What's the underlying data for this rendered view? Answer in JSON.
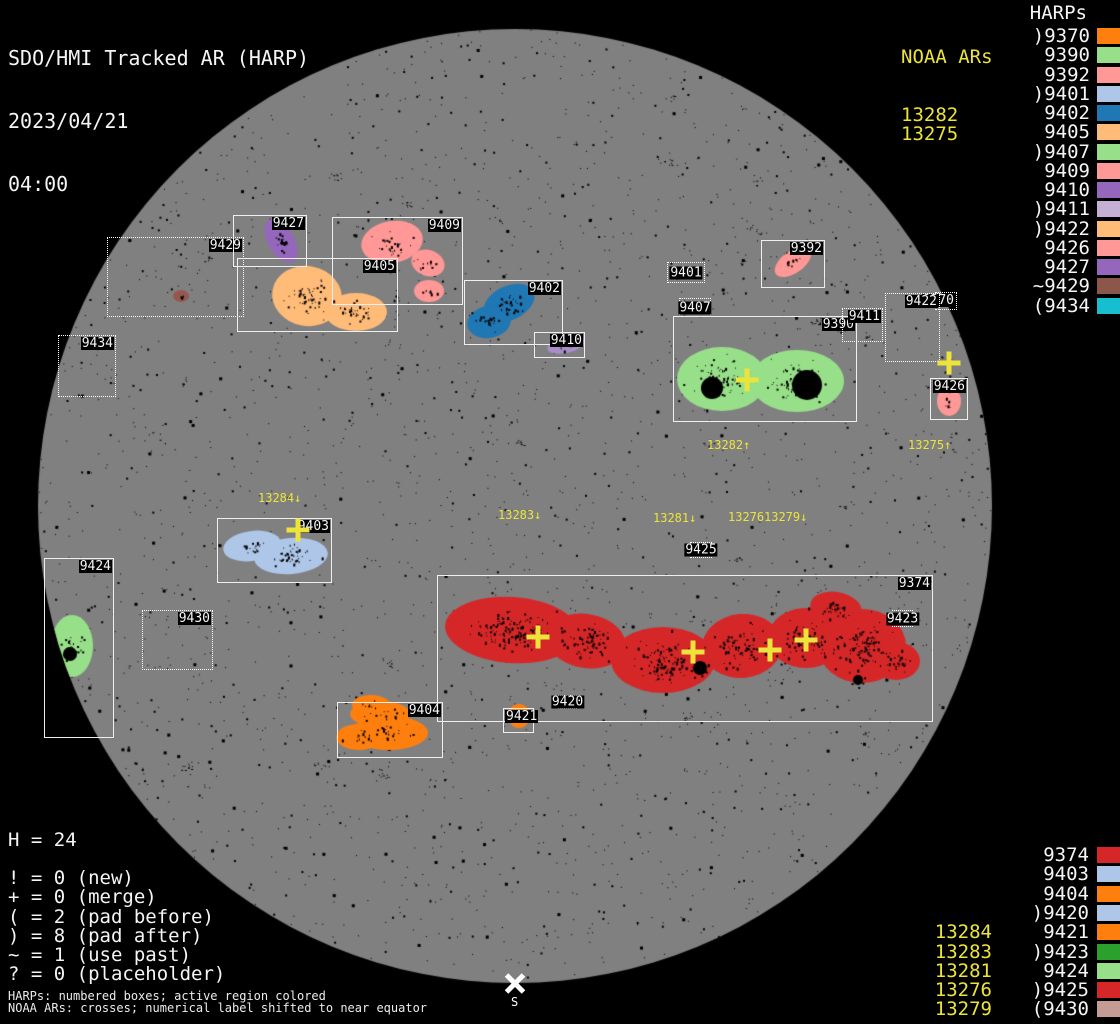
{
  "header": {
    "title": "SDO/HMI Tracked AR (HARP)",
    "date": "2023/04/21",
    "time": "04:00"
  },
  "noaa_panel": {
    "header": "NOAA ARs",
    "values": [
      "13282",
      "13275"
    ]
  },
  "harps_panel_top": {
    "header": "HARPs",
    "items": [
      {
        "label": ")9370",
        "color": "#ff7f0e"
      },
      {
        "label": "9390",
        "color": "#98df8a"
      },
      {
        "label": "9392",
        "color": "#ff9896"
      },
      {
        "label": ")9401",
        "color": "#aec7e8"
      },
      {
        "label": "9402",
        "color": "#1f77b4"
      },
      {
        "label": "9405",
        "color": "#ffbb78"
      },
      {
        "label": ")9407",
        "color": "#98df8a"
      },
      {
        "label": "9409",
        "color": "#ff9896"
      },
      {
        "label": "9410",
        "color": "#9467bd"
      },
      {
        "label": ")9411",
        "color": "#c5b0d5"
      },
      {
        "label": ")9422",
        "color": "#ffbb78"
      },
      {
        "label": "9426",
        "color": "#ff9896"
      },
      {
        "label": "9427",
        "color": "#9467bd"
      },
      {
        "label": "~9429",
        "color": "#8c564b"
      },
      {
        "label": "(9434",
        "color": "#17becf"
      }
    ]
  },
  "harps_panel_bottom": {
    "items": [
      {
        "label": "9374",
        "color": "#d62728",
        "noaa": ""
      },
      {
        "label": "9403",
        "color": "#aec7e8",
        "noaa": ""
      },
      {
        "label": "9404",
        "color": "#ff7f0e",
        "noaa": ""
      },
      {
        "label": ")9420",
        "color": "#aec7e8",
        "noaa": ""
      },
      {
        "label": "9421",
        "color": "#ff7f0e",
        "noaa": "13284"
      },
      {
        "label": ")9423",
        "color": "#2ca02c",
        "noaa": "13283"
      },
      {
        "label": "9424",
        "color": "#98df8a",
        "noaa": "13281"
      },
      {
        "label": ")9425",
        "color": "#d62728",
        "noaa": "13276"
      },
      {
        "label": "(9430",
        "color": "#c49c94",
        "noaa": "13279"
      }
    ]
  },
  "legend": {
    "h_count": "H = 24",
    "flags": [
      "! = 0 (new)",
      "+ = 0 (merge)",
      "( = 2 (pad before)",
      ") = 8 (pad after)",
      "~ = 1 (use past)",
      "? = 0 (placeholder)"
    ],
    "footnotes": [
      "HARPs: numbered boxes; active region colored",
      "NOAA ARs: crosses; numerical label shifted to near equator"
    ]
  },
  "south_marker": {
    "label": "S"
  },
  "colors": {
    "background": "#000000",
    "disk": "#808080",
    "box_border": "#efefef",
    "label_text": "#f5f5f5",
    "noaa_yellow": "#ece43a"
  },
  "chart_data": {
    "type": "scatter",
    "title": "SDO/HMI Tracked AR (HARP)",
    "datetime": "2023/04/21 04:00",
    "sun_disk": {
      "cx": 515,
      "cy": 506,
      "r": 477
    },
    "boxes": [
      {
        "harp": "9429",
        "x": 107,
        "y": 237,
        "w": 137,
        "h": 80,
        "style": "dotted",
        "label_pos": "tr"
      },
      {
        "harp": "9427",
        "x": 233,
        "y": 215,
        "w": 74,
        "h": 52,
        "style": "solid",
        "label_pos": "tr"
      },
      {
        "harp": "9409",
        "x": 332,
        "y": 217,
        "w": 131,
        "h": 88,
        "style": "solid",
        "label_pos": "tr"
      },
      {
        "harp": "9405",
        "x": 237,
        "y": 258,
        "w": 161,
        "h": 74,
        "style": "solid",
        "label_pos": "tr"
      },
      {
        "harp": "9434",
        "x": 58,
        "y": 335,
        "w": 58,
        "h": 62,
        "style": "dotted",
        "label_pos": "tr"
      },
      {
        "harp": "9402",
        "x": 464,
        "y": 280,
        "w": 99,
        "h": 65,
        "style": "solid",
        "label_pos": "tr"
      },
      {
        "harp": "9410",
        "x": 534,
        "y": 332,
        "w": 51,
        "h": 26,
        "style": "solid",
        "label_pos": "tr"
      },
      {
        "harp": "9401",
        "x": 667,
        "y": 262,
        "w": 38,
        "h": 21,
        "style": "dotted",
        "label_pos": "center"
      },
      {
        "harp": "9392",
        "x": 761,
        "y": 240,
        "w": 64,
        "h": 48,
        "style": "solid",
        "label_pos": "tr"
      },
      {
        "harp": "9407",
        "x": 679,
        "y": 298,
        "w": 32,
        "h": 19,
        "style": "dotted",
        "label_pos": "center"
      },
      {
        "harp": "9390",
        "x": 673,
        "y": 316,
        "w": 184,
        "h": 106,
        "style": "solid",
        "label_pos": "tr"
      },
      {
        "harp": "9411",
        "x": 842,
        "y": 308,
        "w": 41,
        "h": 34,
        "style": "dotted",
        "label_pos": "tr"
      },
      {
        "harp": "9370",
        "x": 935,
        "y": 292,
        "w": 22,
        "h": 18,
        "style": "dotted",
        "label_pos": "tr"
      },
      {
        "harp": "9422",
        "x": 885,
        "y": 293,
        "w": 55,
        "h": 69,
        "style": "dotted",
        "label_pos": "tr"
      },
      {
        "harp": "9426",
        "x": 930,
        "y": 378,
        "w": 38,
        "h": 42,
        "style": "solid",
        "label_pos": "tr"
      },
      {
        "harp": "9403",
        "x": 217,
        "y": 518,
        "w": 115,
        "h": 65,
        "style": "solid",
        "label_pos": "tr"
      },
      {
        "harp": "9424",
        "x": 44,
        "y": 558,
        "w": 70,
        "h": 180,
        "style": "solid",
        "label_pos": "tr"
      },
      {
        "harp": "9430",
        "x": 142,
        "y": 610,
        "w": 71,
        "h": 60,
        "style": "dotted",
        "label_pos": "tr"
      },
      {
        "harp": "9374",
        "x": 437,
        "y": 575,
        "w": 496,
        "h": 147,
        "style": "solid",
        "label_pos": "tr"
      },
      {
        "harp": "9423",
        "x": 892,
        "y": 610,
        "w": 21,
        "h": 17,
        "style": "dotted",
        "label_pos": "center"
      },
      {
        "harp": "9425",
        "x": 690,
        "y": 542,
        "w": 22,
        "h": 16,
        "style": "dotted",
        "label_pos": "center"
      },
      {
        "harp": "9420",
        "x": 558,
        "y": 695,
        "w": 19,
        "h": 14,
        "style": "dotted",
        "label_pos": "center"
      },
      {
        "harp": "9421",
        "x": 503,
        "y": 708,
        "w": 31,
        "h": 25,
        "style": "solid",
        "label_pos": "tl"
      },
      {
        "harp": "9404",
        "x": 337,
        "y": 702,
        "w": 106,
        "h": 56,
        "style": "solid",
        "label_pos": "tr"
      }
    ],
    "regions": [
      {
        "harp": "9429",
        "color": "#96584e",
        "lobes": [
          [
            181,
            296,
            8,
            6,
            0
          ]
        ],
        "noise": 4,
        "spots": []
      },
      {
        "harp": "9427",
        "color": "#9467bd",
        "lobes": [
          [
            281,
            241,
            13,
            24,
            -30
          ]
        ],
        "noise": 18,
        "spots": []
      },
      {
        "harp": "9409",
        "color": "#ff9896",
        "lobes": [
          [
            392,
            242,
            31,
            21,
            -10
          ],
          [
            428,
            263,
            17,
            13,
            20
          ],
          [
            429,
            291,
            15,
            11,
            0
          ]
        ],
        "noise": 50,
        "spots": []
      },
      {
        "harp": "9405",
        "color": "#ffbb78",
        "lobes": [
          [
            307,
            296,
            35,
            30,
            10
          ],
          [
            356,
            312,
            31,
            19,
            0
          ]
        ],
        "noise": 85,
        "spots": []
      },
      {
        "harp": "9402",
        "color": "#1f77b4",
        "lobes": [
          [
            509,
            303,
            27,
            17,
            -25
          ],
          [
            489,
            322,
            22,
            16,
            -10
          ]
        ],
        "noise": 50,
        "spots": []
      },
      {
        "harp": "9410",
        "color": "#a98ec9",
        "lobes": [
          [
            566,
            345,
            19,
            8,
            -12
          ]
        ],
        "noise": 8,
        "spots": []
      },
      {
        "harp": "9392",
        "color": "#ff9896",
        "lobes": [
          [
            793,
            262,
            21,
            11,
            -35
          ]
        ],
        "noise": 12,
        "spots": []
      },
      {
        "harp": "9390",
        "color": "#98df8a",
        "lobes": [
          [
            722,
            379,
            45,
            32,
            0
          ],
          [
            797,
            381,
            47,
            31,
            0
          ]
        ],
        "noise": 150,
        "spots": [
          [
            712,
            388,
            11
          ],
          [
            807,
            385,
            15
          ]
        ]
      },
      {
        "harp": "9426",
        "color": "#ff9896",
        "lobes": [
          [
            949,
            401,
            12,
            15,
            0
          ]
        ],
        "noise": 8,
        "spots": []
      },
      {
        "harp": "9403",
        "color": "#aec7e8",
        "lobes": [
          [
            252,
            546,
            29,
            15,
            -8
          ],
          [
            291,
            556,
            37,
            18,
            -5
          ]
        ],
        "noise": 60,
        "spots": []
      },
      {
        "harp": "9424",
        "color": "#98df8a",
        "lobes": [
          [
            72,
            646,
            21,
            31,
            0
          ]
        ],
        "noise": 20,
        "spots": [
          [
            70,
            654,
            7
          ]
        ]
      },
      {
        "harp": "9374",
        "color": "#d62728",
        "lobes": [
          [
            512,
            630,
            67,
            33,
            4
          ],
          [
            586,
            641,
            40,
            27,
            10
          ],
          [
            663,
            660,
            52,
            33,
            0
          ],
          [
            742,
            646,
            40,
            32,
            -5
          ],
          [
            806,
            638,
            38,
            30,
            0
          ],
          [
            862,
            646,
            44,
            37,
            0
          ],
          [
            896,
            661,
            24,
            19,
            0
          ],
          [
            836,
            608,
            26,
            16,
            10
          ]
        ],
        "noise": 650,
        "spots": [
          [
            700,
            668,
            7
          ],
          [
            858,
            680,
            5
          ]
        ]
      },
      {
        "harp": "9404",
        "color": "#ff7f0e",
        "lobes": [
          [
            380,
            714,
            30,
            13,
            0
          ],
          [
            389,
            733,
            39,
            17,
            0
          ],
          [
            359,
            737,
            23,
            13,
            0
          ],
          [
            371,
            705,
            19,
            10,
            0
          ]
        ],
        "noise": 60,
        "spots": []
      },
      {
        "harp": "9421",
        "color": "#ff7f0e",
        "lobes": [
          [
            519,
            716,
            11,
            12,
            0
          ]
        ],
        "noise": 6,
        "spots": []
      }
    ],
    "crosses": [
      [
        747,
        380
      ],
      [
        949,
        363
      ],
      [
        298,
        530
      ],
      [
        538,
        637
      ],
      [
        693,
        652
      ],
      [
        770,
        650
      ],
      [
        806,
        640
      ]
    ],
    "cross_labels": [
      {
        "text": "13282↑",
        "x": 707,
        "y": 439
      },
      {
        "text": "13275↑",
        "x": 908,
        "y": 439
      },
      {
        "text": "13284↓",
        "x": 258,
        "y": 492
      },
      {
        "text": "13283↓",
        "x": 498,
        "y": 509
      },
      {
        "text": "13281↓",
        "x": 653,
        "y": 512
      },
      {
        "text": "13276",
        "x": 728,
        "y": 511
      },
      {
        "text": "13279↓",
        "x": 764,
        "y": 511
      }
    ],
    "south_pole": {
      "x": 515,
      "y": 983
    }
  }
}
